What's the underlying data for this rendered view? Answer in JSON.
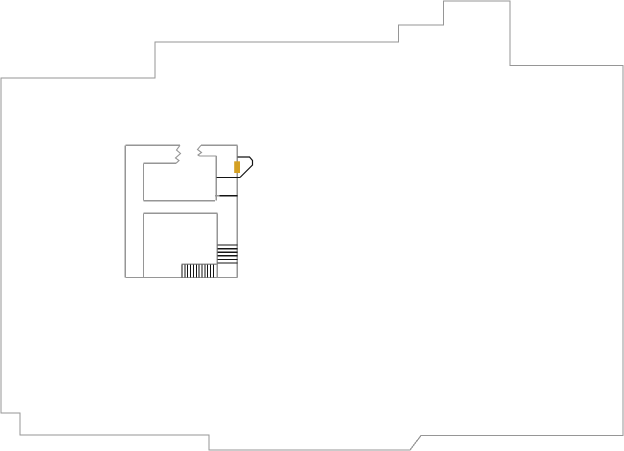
{
  "canvas": {
    "width": 624,
    "height": 451,
    "background": "#ffffff"
  },
  "colors": {
    "wall_gray": "#969696",
    "detail_black": "#141414",
    "door_marker_orange": "#d4a023",
    "paper_white": "#ffffff"
  },
  "floor_plan": {
    "outer_boundary_points": "1,78 155,78 155,42 398.5,42 398.5,25 443.5,25 443.5,1 510,1 510,65.5 623,65.5 623,435.5 421,435.5 410,450 209,450 209,435 20,435 20,413 1,413",
    "wall_segments": [
      {
        "name": "top-wall-left",
        "x1": 125.3,
        "y1": 145.3,
        "x2": 180,
        "y2": 145.3
      },
      {
        "name": "top-wall-right",
        "x1": 201,
        "y1": 145.3,
        "x2": 237.3,
        "y2": 145.3
      },
      {
        "name": "west-wall",
        "x1": 125.3,
        "y1": 145.3,
        "x2": 125.3,
        "y2": 277.5
      },
      {
        "name": "east-shaft-wall",
        "x1": 237.3,
        "y1": 145.3,
        "x2": 237.3,
        "y2": 277.5
      },
      {
        "name": "upper-room-top",
        "x1": 143.5,
        "y1": 163.3,
        "x2": 176,
        "y2": 163.3
      },
      {
        "name": "upper-room-left",
        "x1": 143.5,
        "y1": 163.3,
        "x2": 143.5,
        "y2": 200.7
      },
      {
        "name": "mid-corridor-top",
        "x1": 143.5,
        "y1": 200.7,
        "x2": 215,
        "y2": 200.7
      },
      {
        "name": "upper-right-room-top",
        "x1": 199.5,
        "y1": 156,
        "x2": 216.3,
        "y2": 156
      },
      {
        "name": "upper-right-room-side",
        "x1": 216.3,
        "y1": 156,
        "x2": 216.3,
        "y2": 200.7
      },
      {
        "name": "alcove-stub",
        "x1": 215,
        "y1": 195.7,
        "x2": 219.5,
        "y2": 195.7
      },
      {
        "name": "mid-corridor-bottom",
        "x1": 143.5,
        "y1": 213.3,
        "x2": 217.3,
        "y2": 213.3
      },
      {
        "name": "lower-room-left",
        "x1": 143.5,
        "y1": 213.3,
        "x2": 143.5,
        "y2": 277.5
      },
      {
        "name": "stair-shaft-left",
        "x1": 217.3,
        "y1": 213.3,
        "x2": 217.3,
        "y2": 277.5
      },
      {
        "name": "south-wall",
        "x1": 125.3,
        "y1": 277.5,
        "x2": 237.3,
        "y2": 277.5
      },
      {
        "name": "lower-stair-top",
        "x1": 181.7,
        "y1": 264.3,
        "x2": 217.3,
        "y2": 264.3
      }
    ],
    "wall_breaks": [
      {
        "name": "break-mark-left",
        "points": "180,145.3 176.5,150 180.5,153.5 175.5,158 179,160.5 176,163.3"
      },
      {
        "name": "break-mark-right",
        "points": "201,145.3 197.5,149.5 201.5,152.5 198,155 199.5,156"
      }
    ],
    "door_lines": [
      {
        "name": "door-threshold-upper",
        "x1": 216.3,
        "y1": 177.5,
        "x2": 240,
        "y2": 177.5
      },
      {
        "name": "door-threshold-lower",
        "x1": 219.5,
        "y1": 195.7,
        "x2": 237.3,
        "y2": 195.7
      }
    ],
    "door_swing_points": "237.5,157 249.5,157 252.5,160.5 252.5,165 240,177.5",
    "door_marker": {
      "x": 234.2,
      "y": 161.3,
      "width": 5.8,
      "height": 11.7
    },
    "stairs": [
      {
        "name": "stair-upper-run",
        "orientation": "horizontal",
        "span_from": 217.3,
        "span_to": 237.3,
        "start": 245,
        "step": 3.6,
        "count": 6
      },
      {
        "name": "stair-lower-run",
        "orientation": "vertical",
        "span_from": 264.5,
        "span_to": 277.3,
        "start": 182,
        "step": 2.85,
        "count": 12
      }
    ]
  }
}
